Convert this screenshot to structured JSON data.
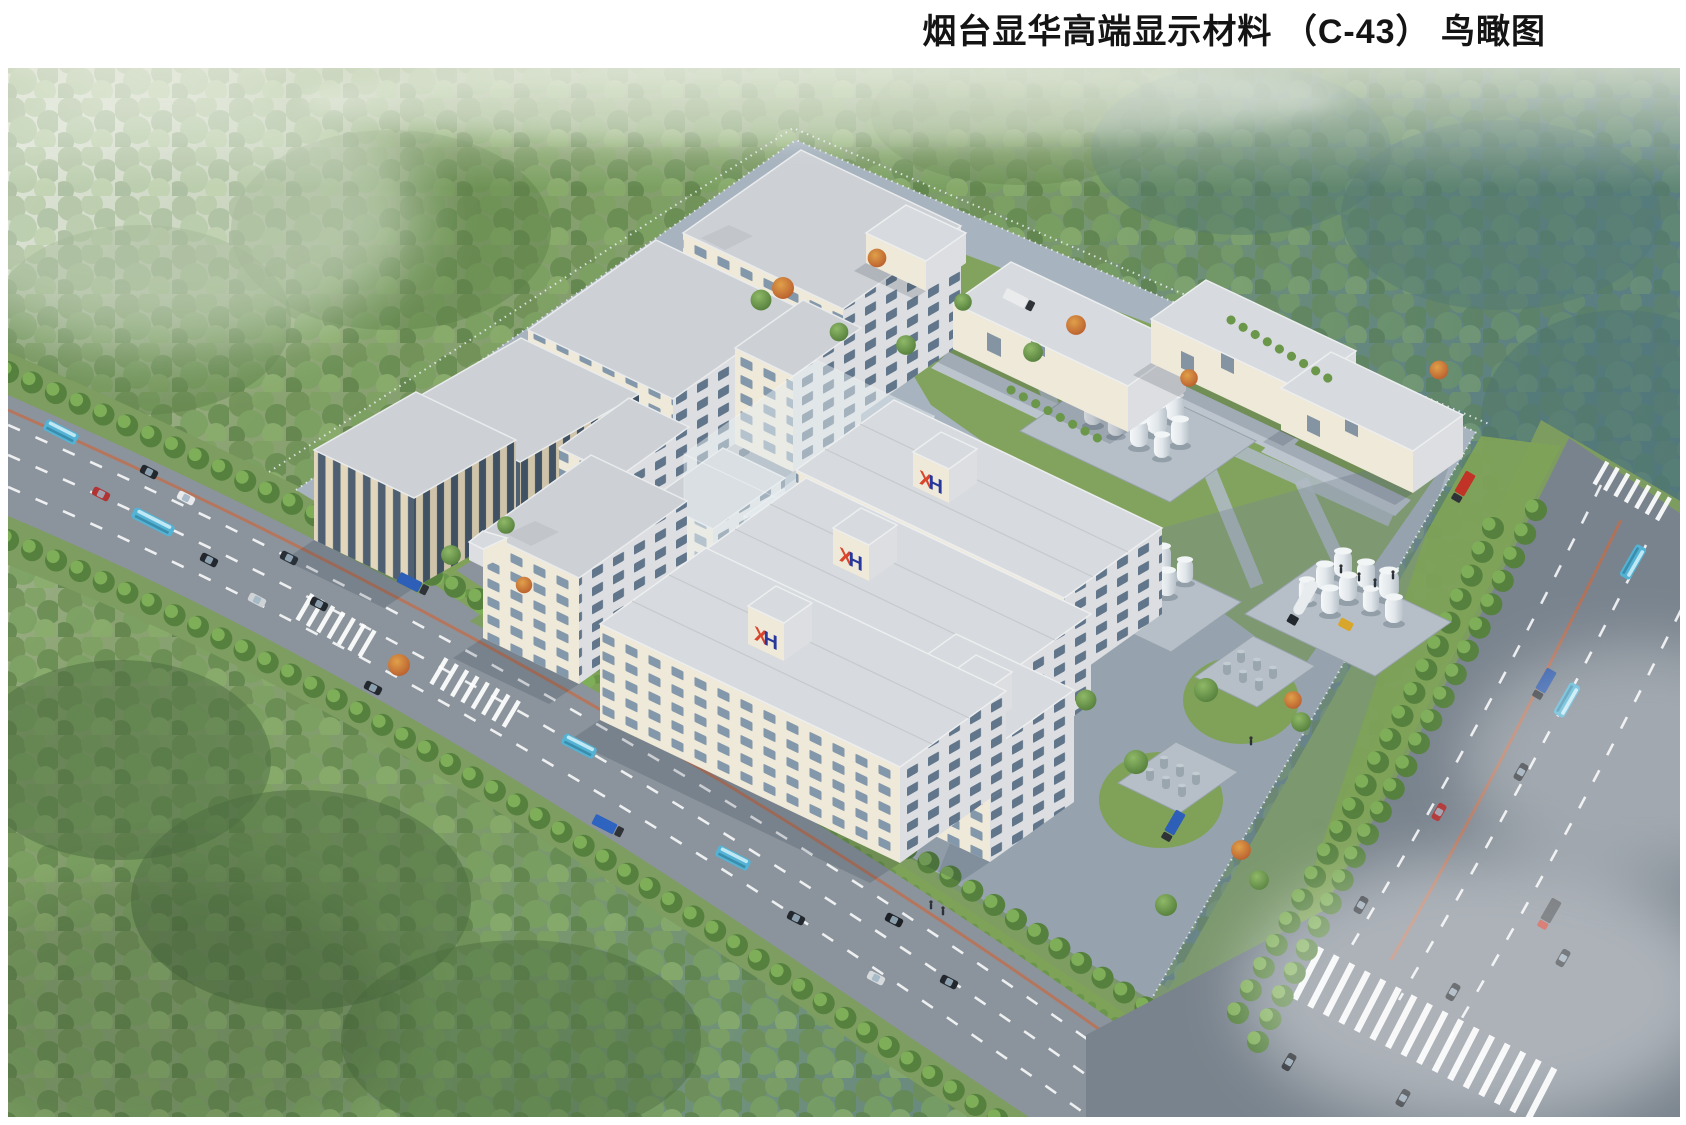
{
  "header": {
    "title": "烟台显华高端显示材料 （C-43） 鸟瞰图"
  },
  "branding": {
    "logo_text": "XH",
    "logo_x": "X",
    "logo_h": "H",
    "logo_red": "#d9452b",
    "logo_blue": "#27379b"
  },
  "palette": {
    "page_bg": "#ffffff",
    "title_color": "#141414",
    "forest_green": "#76905f",
    "forest_teal": "#5d7f83",
    "lawn_green": "#7fa258",
    "road_gray": "#8b949c",
    "building_wall": "#efe9d9",
    "building_shade": "#dcdee1",
    "roof_gray": "#cdd1d5",
    "tank_white": "#f0f3f4",
    "bus_teal": "#54b3d4"
  }
}
